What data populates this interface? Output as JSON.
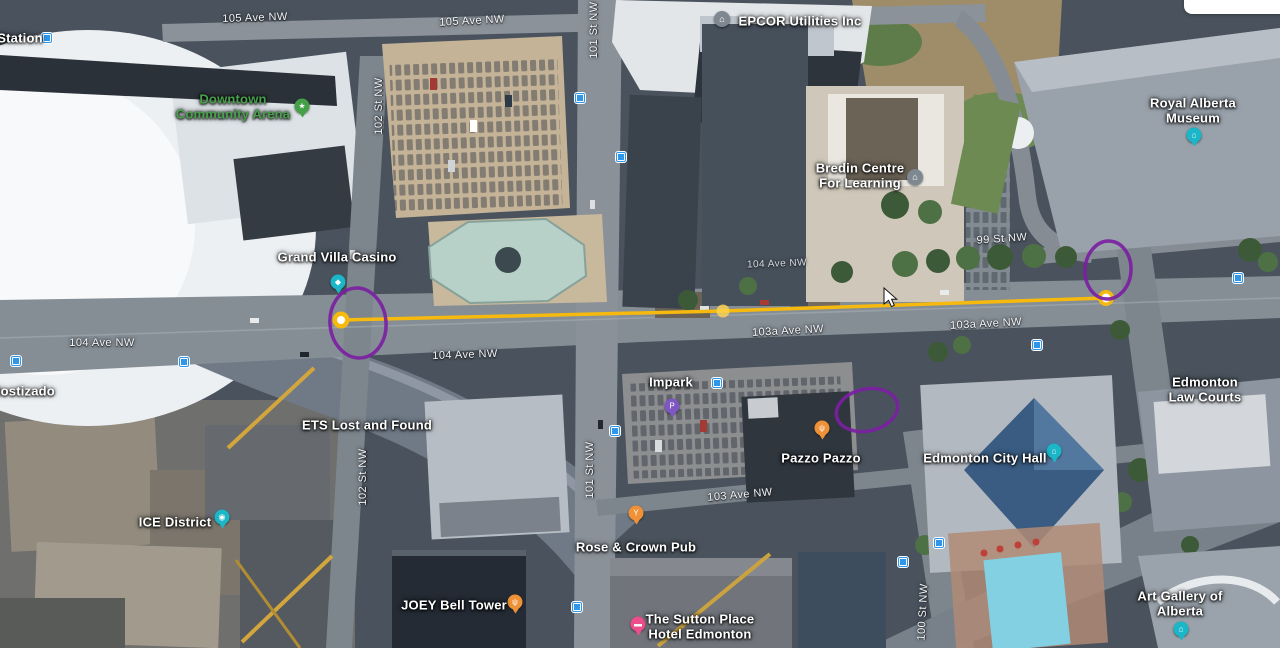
{
  "places": [
    {
      "id": "station",
      "name": "Station",
      "x": 20,
      "y": 38,
      "color": "#ffffff"
    },
    {
      "id": "downtown-community-arena",
      "name": "Downtown\nCommunity Arena",
      "x": 233,
      "y": 107,
      "color": "#47a24b"
    },
    {
      "id": "grand-villa-casino",
      "name": "Grand Villa Casino",
      "x": 337,
      "y": 257,
      "color": "#ffffff"
    },
    {
      "id": "epcor-utilities",
      "name": "EPCOR Utilities Inc",
      "x": 800,
      "y": 21,
      "color": "#ffffff"
    },
    {
      "id": "bredin-centre",
      "name": "Bredin Centre\nFor Learning",
      "x": 860,
      "y": 176,
      "color": "#ffffff"
    },
    {
      "id": "royal-alberta-museum",
      "name": "Royal Alberta Museum",
      "x": 1193,
      "y": 111,
      "color": "#ffffff"
    },
    {
      "id": "edmonton-law-courts",
      "name": "Edmonton Law Courts",
      "x": 1205,
      "y": 390,
      "color": "#ffffff"
    },
    {
      "id": "edmonton-city-hall",
      "name": "Edmonton City Hall",
      "x": 985,
      "y": 458,
      "color": "#ffffff"
    },
    {
      "id": "art-gallery-of-alberta",
      "name": "Art Gallery of Alberta",
      "x": 1180,
      "y": 604,
      "color": "#ffffff"
    },
    {
      "id": "ice-district",
      "name": "ICE District",
      "x": 175,
      "y": 522,
      "color": "#ffffff"
    },
    {
      "id": "ets-lost-and-found",
      "name": "ETS Lost and Found",
      "x": 367,
      "y": 425,
      "color": "#ffffff"
    },
    {
      "id": "impark",
      "name": "Impark",
      "x": 671,
      "y": 382,
      "color": "#ffffff"
    },
    {
      "id": "pazzo-pazzo",
      "name": "Pazzo Pazzo",
      "x": 821,
      "y": 458,
      "color": "#ffffff"
    },
    {
      "id": "rose-and-crown-pub",
      "name": "Rose & Crown Pub",
      "x": 636,
      "y": 547,
      "color": "#ffffff"
    },
    {
      "id": "joey-bell-tower",
      "name": "JOEY Bell Tower",
      "x": 454,
      "y": 605,
      "color": "#ffffff"
    },
    {
      "id": "sutton-place-hotel",
      "name": "The Sutton Place\nHotel Edmonton",
      "x": 700,
      "y": 627,
      "color": "#ffffff"
    },
    {
      "id": "rostizado",
      "name": "Rostizado",
      "x": 23,
      "y": 391,
      "color": "#ffffff"
    }
  ],
  "streets": [
    {
      "name": "105 Ave NW",
      "x": 255,
      "y": 18,
      "rot": "translate(-50%,-50%) rotate(-2deg)"
    },
    {
      "name": "105 Ave NW",
      "x": 472,
      "y": 21,
      "rot": "translate(-50%,-50%) rotate(-3deg)"
    },
    {
      "name": "101 St NW",
      "x": 594,
      "y": 30,
      "rot": "translate(-50%,-50%) rotate(-90deg)"
    },
    {
      "name": "102 St NW",
      "x": 379,
      "y": 106,
      "rot": "translate(-50%,-50%) rotate(-90deg)"
    },
    {
      "name": "99 St NW",
      "x": 1002,
      "y": 239,
      "rot": "translate(-50%,-50%) rotate(-4deg)"
    },
    {
      "name": "104 Ave NW",
      "x": 777,
      "y": 264,
      "rot": "translate(-50%,-50%) rotate(-2deg)",
      "class": "small"
    },
    {
      "name": "103a Ave NW",
      "x": 788,
      "y": 331,
      "rot": "translate(-50%,-50%) rotate(-3deg)"
    },
    {
      "name": "103a Ave NW",
      "x": 986,
      "y": 324,
      "rot": "translate(-50%,-50%) rotate(-3deg)"
    },
    {
      "name": "104 Ave NW",
      "x": 102,
      "y": 343
    },
    {
      "name": "104 Ave NW",
      "x": 465,
      "y": 355,
      "rot": "translate(-50%,-50%) rotate(-2deg)"
    },
    {
      "name": "102 St NW",
      "x": 363,
      "y": 477,
      "rot": "translate(-50%,-50%) rotate(-90deg)"
    },
    {
      "name": "101 St NW",
      "x": 590,
      "y": 470,
      "rot": "translate(-50%,-50%) rotate(-90deg)"
    },
    {
      "name": "103 Ave NW",
      "x": 740,
      "y": 495,
      "rot": "translate(-50%,-50%) rotate(-5deg)"
    },
    {
      "name": "100 St NW",
      "x": 923,
      "y": 612,
      "rot": "translate(-50%,-50%) rotate(-87deg)"
    }
  ],
  "pins": [
    {
      "id": "arena-pin",
      "x": 302,
      "y": 106,
      "color": "#43a047",
      "glyph": "★"
    },
    {
      "id": "casino-pin",
      "x": 338,
      "y": 282,
      "color": "#1bb6c7",
      "glyph": "◆"
    },
    {
      "id": "museum-pin",
      "x": 1194,
      "y": 135,
      "color": "#1bb6c7",
      "glyph": "⌂"
    },
    {
      "id": "city-hall-pin",
      "x": 1054,
      "y": 451,
      "color": "#1bb6c7",
      "glyph": "⌂"
    },
    {
      "id": "art-gallery-pin",
      "x": 1181,
      "y": 629,
      "color": "#1bb6c7",
      "glyph": "⌂"
    },
    {
      "id": "ice-district-camera-pin",
      "x": 222,
      "y": 517,
      "color": "#1bb6c7",
      "glyph": "◉"
    },
    {
      "id": "epcor-building-icon",
      "x": 722,
      "y": 19,
      "color": "#7f8891",
      "glyph": "⌂",
      "class": "circle"
    },
    {
      "id": "bredin-building-icon",
      "x": 915,
      "y": 177,
      "color": "#7f8891",
      "glyph": "⌂",
      "class": "circle"
    },
    {
      "id": "impark-parking-pin",
      "x": 672,
      "y": 406,
      "color": "#7e57c2",
      "glyph": "P"
    },
    {
      "id": "pazzo-restaurant-pin",
      "x": 822,
      "y": 428,
      "color": "#ef9136",
      "glyph": "ψ"
    },
    {
      "id": "rose-crown-pub-pin",
      "x": 636,
      "y": 513,
      "color": "#ef9136",
      "glyph": "Y"
    },
    {
      "id": "joey-restaurant-pin",
      "x": 515,
      "y": 602,
      "color": "#ef9136",
      "glyph": "ψ"
    },
    {
      "id": "sutton-hotel-pin",
      "x": 638,
      "y": 624,
      "color": "#ec4d8b",
      "glyph": "▬"
    }
  ],
  "transit_stops": [
    {
      "x": 47,
      "y": 38
    },
    {
      "x": 580,
      "y": 98
    },
    {
      "x": 621,
      "y": 157
    },
    {
      "x": 16,
      "y": 361
    },
    {
      "x": 184,
      "y": 362
    },
    {
      "x": 615,
      "y": 431
    },
    {
      "x": 717,
      "y": 383
    },
    {
      "x": 577,
      "y": 607
    },
    {
      "x": 939,
      "y": 543
    },
    {
      "x": 903,
      "y": 562
    },
    {
      "x": 1238,
      "y": 278
    },
    {
      "x": 1037,
      "y": 345
    }
  ],
  "annotations": {
    "circle_color": "#7b1fa2",
    "circles": [
      {
        "cx": 358,
        "cy": 323,
        "rx": 28,
        "ry": 35,
        "rot": -6
      },
      {
        "cx": 867,
        "cy": 410,
        "rx": 31,
        "ry": 21,
        "rot": -12
      },
      {
        "cx": 1108,
        "cy": 270,
        "rx": 23,
        "ry": 29,
        "rot": 4
      }
    ],
    "measure_line": {
      "color": "#f6b90d",
      "mid_dot_color": "#ffd54f",
      "points": [
        [
          341,
          320
        ],
        [
          723,
          311
        ],
        [
          1106,
          298
        ]
      ]
    }
  },
  "cursor": {
    "x": 884,
    "y": 288
  }
}
